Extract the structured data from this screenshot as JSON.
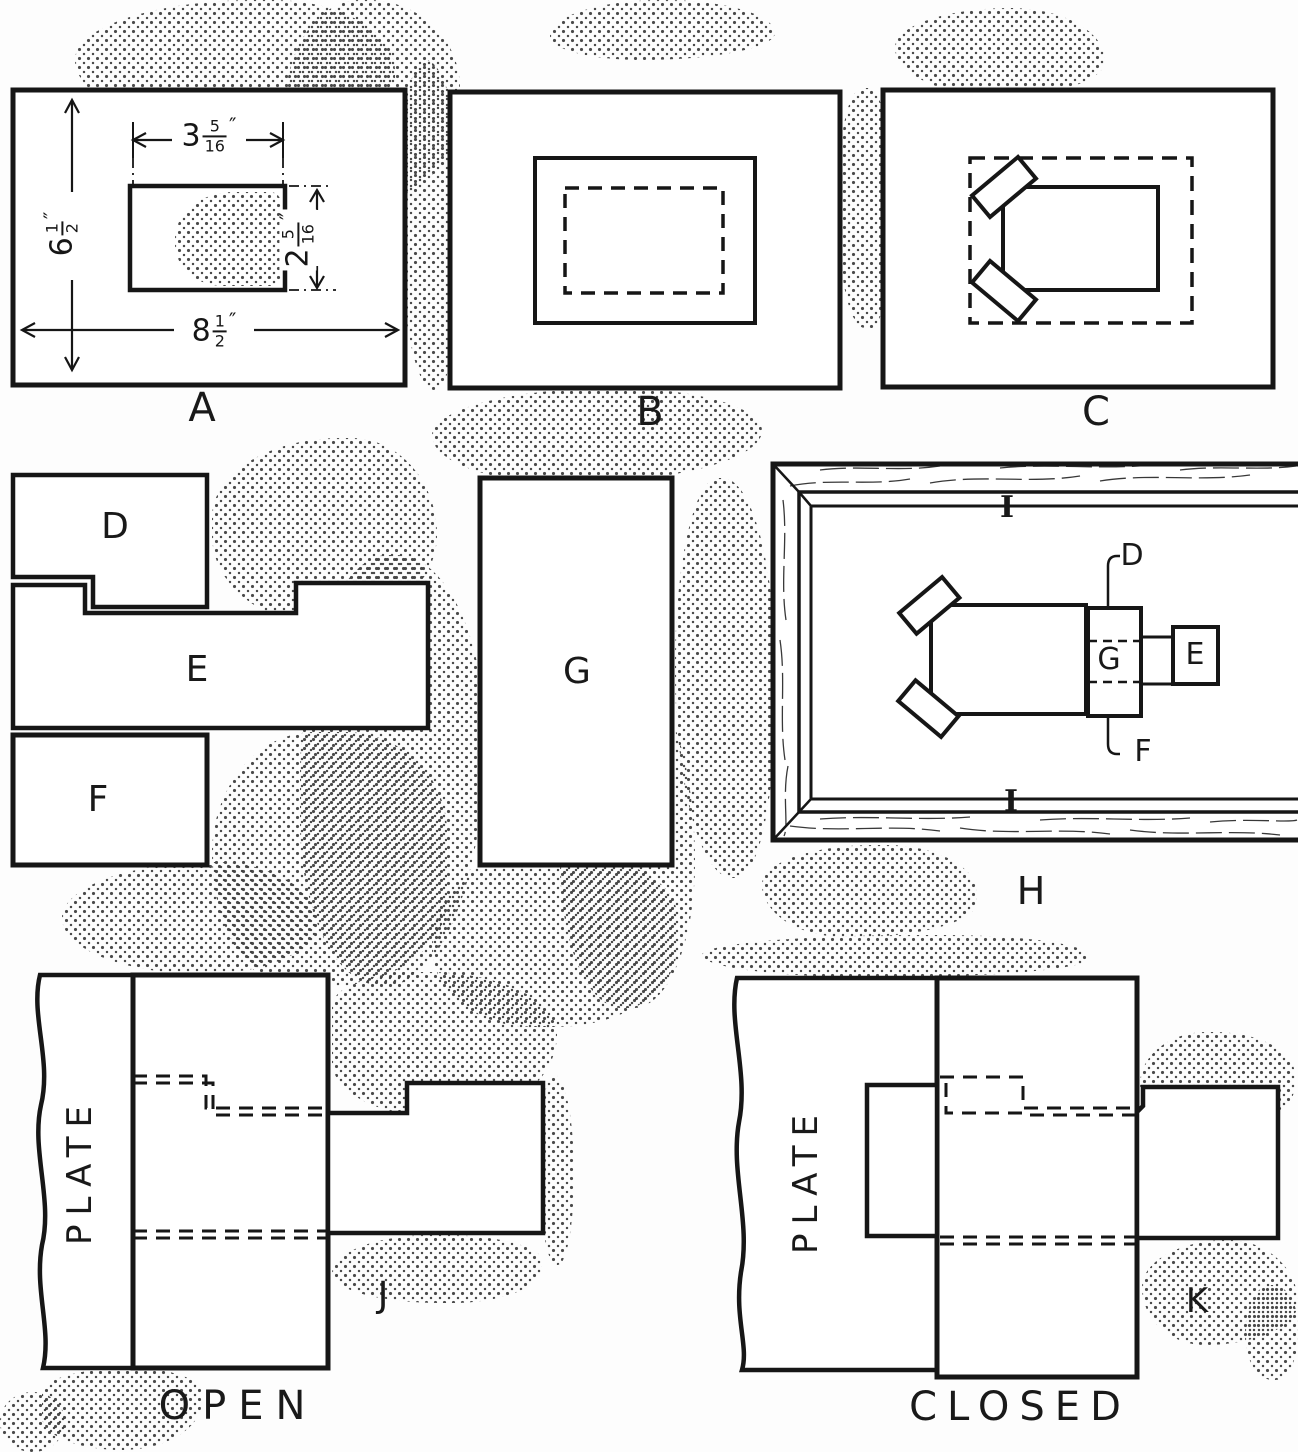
{
  "panels": {
    "a": {
      "label": "A"
    },
    "b": {
      "label": "B"
    },
    "c": {
      "label": "C"
    },
    "d": {
      "label": "D"
    },
    "e": {
      "label": "E"
    },
    "f": {
      "label": "F"
    },
    "g": {
      "label": "G"
    },
    "h": {
      "label": "H"
    },
    "j": {
      "label": "J"
    },
    "k": {
      "label": "K"
    }
  },
  "h_assembly": {
    "d": "D",
    "g": "G",
    "e": "E",
    "f": "F",
    "i_top": "I",
    "i_bottom": "I"
  },
  "dims": {
    "cutout_width": {
      "whole": "3",
      "num": "5",
      "den": "16",
      "unit": "″"
    },
    "cutout_height": {
      "whole": "2",
      "num": "5",
      "den": "16",
      "unit": "″"
    },
    "plate_height": {
      "whole": "6",
      "num": "1",
      "den": "2",
      "unit": "″"
    },
    "plate_width": {
      "whole": "8",
      "num": "1",
      "den": "2",
      "unit": "″"
    }
  },
  "plate_j": "PLATE",
  "plate_k": "PLATE",
  "captions": {
    "open": "OPEN",
    "closed": "CLOSED"
  },
  "ink_color": "#161616"
}
